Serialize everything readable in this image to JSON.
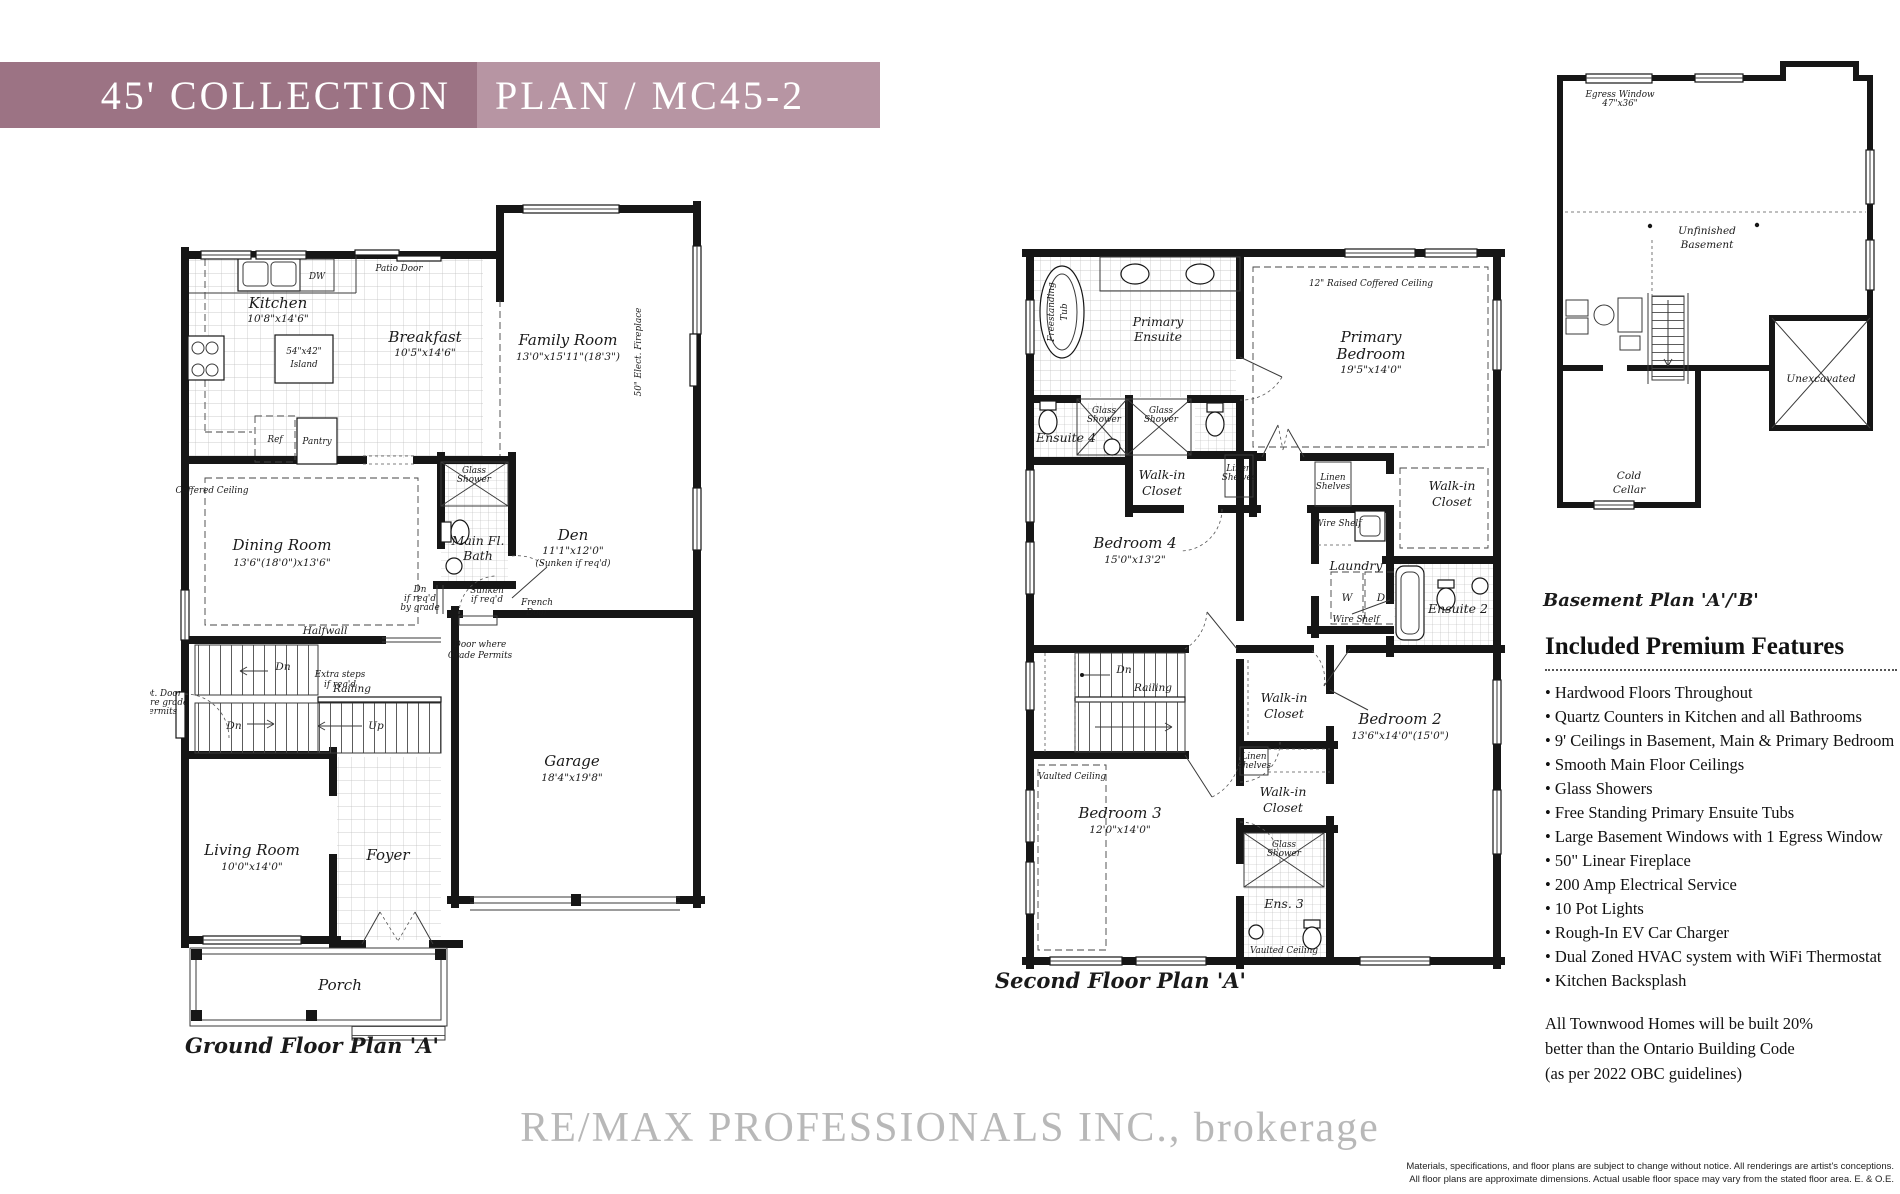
{
  "colors": {
    "banner_dark": "#9C7384",
    "banner_light": "#B795A3",
    "wall": "#161616"
  },
  "header": {
    "collection": "45' COLLECTION",
    "plan_code": "PLAN / MC45-2"
  },
  "ground_floor": {
    "caption": "Ground Floor Plan 'A'",
    "rooms": {
      "kitchen": {
        "name": "Kitchen",
        "dims": "10'8\"x14'6\""
      },
      "breakfast": {
        "name": "Breakfast",
        "dims": "10'5\"x14'6\""
      },
      "family_room": {
        "name": "Family Room",
        "dims": "13'0\"x15'11\"(18'3\")"
      },
      "dining_room": {
        "name": "Dining Room",
        "dims": "13'6\"(18'0\")x13'6\""
      },
      "den": {
        "name": "Den",
        "dims": "11'1\"x12'0\"",
        "note": "(Sunken if req'd)"
      },
      "main_bath_1": "Main Fl.",
      "main_bath_2": "Bath",
      "garage": {
        "name": "Garage",
        "dims": "18'4\"x19'8\""
      },
      "living_room": {
        "name": "Living Room",
        "dims": "10'0\"x14'0\""
      },
      "foyer": "Foyer",
      "porch": "Porch"
    },
    "ann": {
      "island_size": "54\"x42\"",
      "island": "Island",
      "dw": "DW",
      "ref": "Ref",
      "pantry": "Pantry",
      "patio_door": "Patio Door",
      "coffered": "Coffered Ceiling",
      "glass_1": "Glass",
      "glass_2": "Shower",
      "fireplace": "50\" Elect. Fireplace",
      "halfwall": "Halfwall",
      "dn": "Dn",
      "up": "Up",
      "railing": "Railing",
      "extra_1": "Extra steps",
      "extra_2": "if req'd",
      "dngrade_1": "Dn",
      "dngrade_2": "if req'd",
      "dngrade_3": "by grade",
      "sunken_1": "Sunken",
      "sunken_2": "if req'd",
      "french_1": "French",
      "french_2": "Door",
      "doorgrade_1": "Door where",
      "doorgrade_2": "Grade Permits",
      "optdoor_1": "Opt. Door",
      "optdoor_2": "where grade",
      "optdoor_3": "permits"
    }
  },
  "second_floor": {
    "caption": "Second Floor Plan 'A'",
    "rooms": {
      "primary_bedroom": {
        "n1": "Primary",
        "n2": "Bedroom",
        "dims": "19'5\"x14'0\""
      },
      "primary_ensuite": {
        "n1": "Primary",
        "n2": "Ensuite"
      },
      "bedroom_2": {
        "name": "Bedroom 2",
        "dims": "13'6\"x14'0\"(15'0\")"
      },
      "bedroom_3": {
        "name": "Bedroom 3",
        "dims": "12'0\"x14'0\""
      },
      "bedroom_4": {
        "name": "Bedroom 4",
        "dims": "15'0\"x13'2\""
      },
      "ensuite_2": "Ensuite 2",
      "ensuite_3": "Ens. 3",
      "ensuite_4": "Ensuite 4",
      "laundry": "Laundry"
    },
    "ann": {
      "tub_1": "Freestanding",
      "tub_2": "Tub",
      "glass_1": "Glass",
      "glass_2": "Shower",
      "wic_1": "Walk-in",
      "wic_2": "Closet",
      "linen_1": "Linen",
      "linen_2": "Shelves",
      "raised": "12\" Raised Coffered Ceiling",
      "wire_shelf": "Wire Shelf",
      "washer": "W",
      "dryer": "D",
      "vaulted": "Vaulted Ceiling",
      "dn": "Dn",
      "railing": "Railing"
    }
  },
  "basement": {
    "caption": "Basement Plan 'A'/'B'",
    "ann": {
      "unfinished_1": "Unfinished",
      "unfinished_2": "Basement",
      "unexcavated": "Unexcavated",
      "cold_1": "Cold",
      "cold_2": "Cellar",
      "egress_1": "Egress Window",
      "egress_2": "47\"x36\""
    }
  },
  "features": {
    "title": "Included Premium Features",
    "items": [
      "Hardwood Floors Throughout",
      "Quartz Counters in Kitchen and all Bathrooms",
      "9' Ceilings in Basement, Main & Primary Bedroom",
      "Smooth Main Floor Ceilings",
      "Glass Showers",
      "Free Standing Primary Ensuite Tubs",
      "Large Basement Windows with 1 Egress Window",
      "50\" Linear Fireplace",
      "200 Amp Electrical Service",
      "10 Pot Lights",
      "Rough-In EV Car Charger",
      "Dual Zoned HVAC system with WiFi Thermostat",
      "Kitchen Backsplash"
    ],
    "note_lines": [
      "All Townwood Homes will be built 20%",
      "better than the Ontario Building Code",
      "(as per 2022 OBC guidelines)"
    ]
  },
  "watermark": "RE/MAX PROFESSIONALS INC., brokerage",
  "disclaimer": {
    "line1": "Materials, specifications, and floor plans are subject to change without notice. All renderings are artist's conceptions.",
    "line2": "All floor plans are approximate dimensions. Actual usable floor space may vary from the stated floor area. E. & O.E."
  }
}
